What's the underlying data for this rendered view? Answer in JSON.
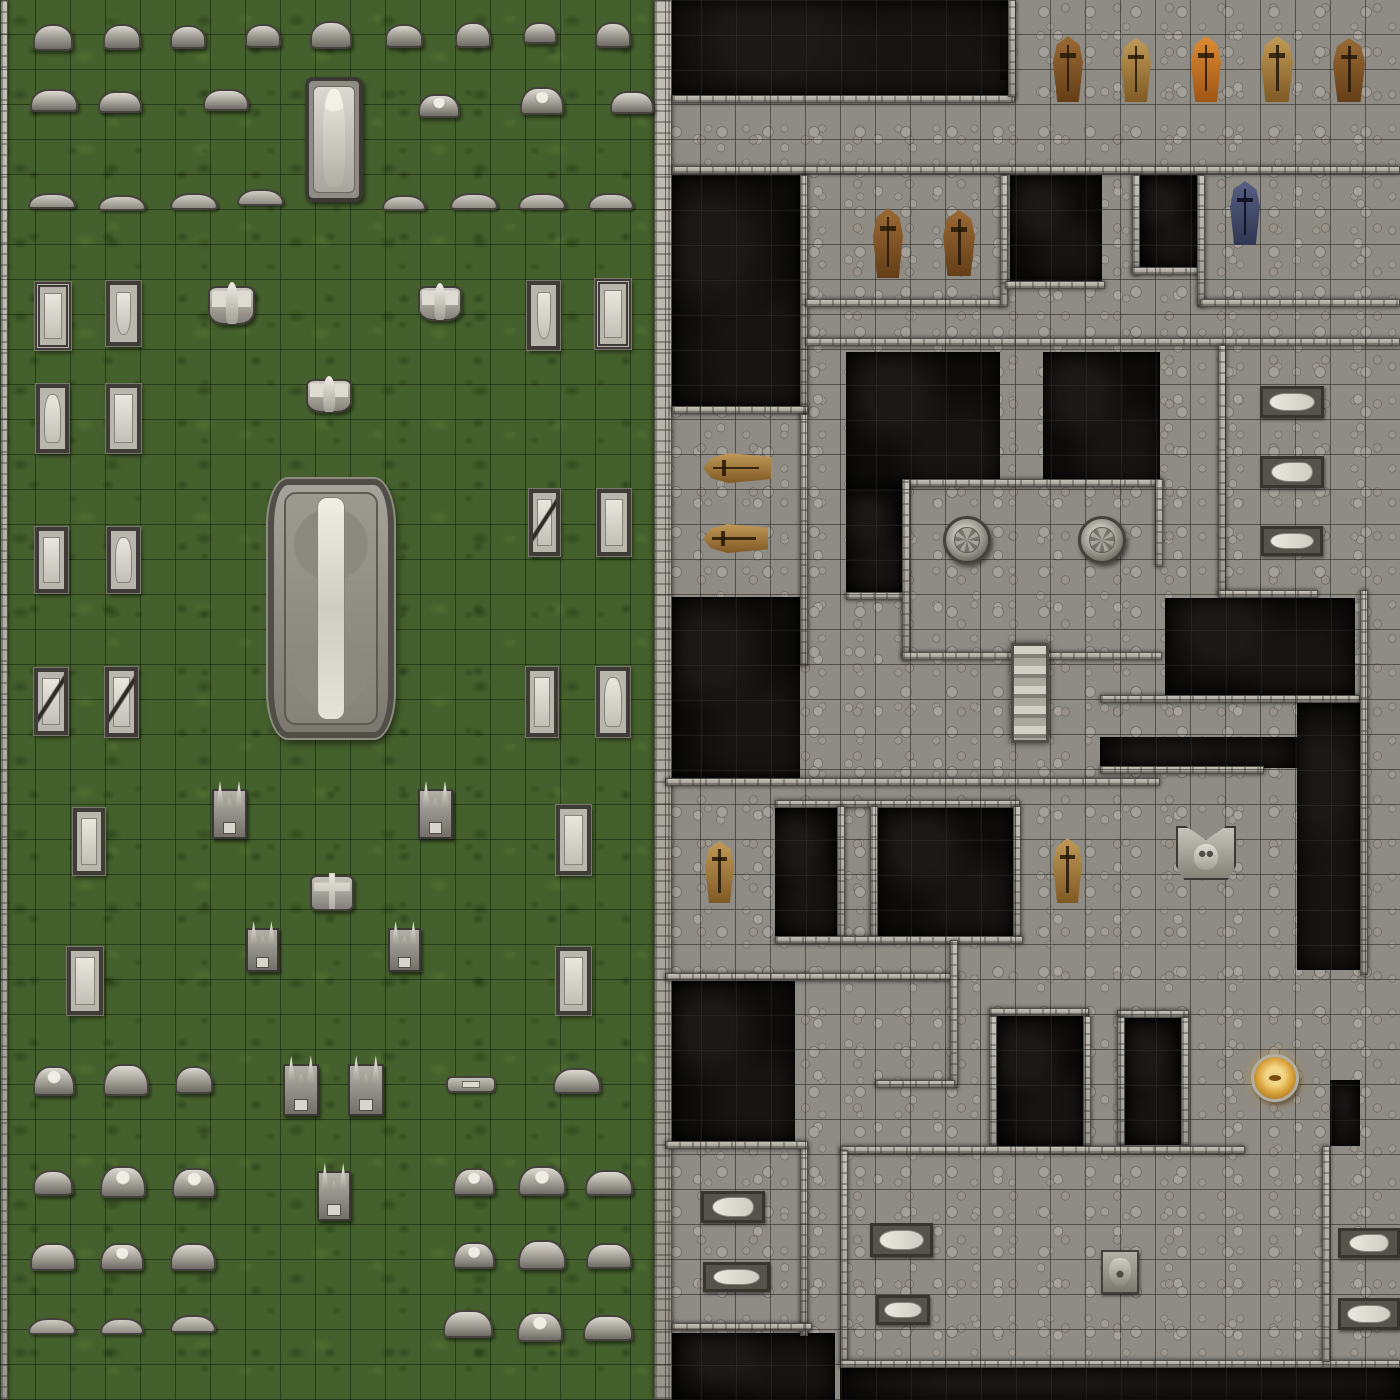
{
  "map": {
    "name": "graveyard-and-crypt-battle-map",
    "width_px": 1400,
    "height_px": 1400,
    "grid": {
      "cell_px": 35,
      "cols": 40,
      "rows": 40
    },
    "palette": {
      "grass": "#44602c",
      "stone": "#8f8c85",
      "wall": "#b0ada5",
      "void": "#0d0c0b",
      "gold": "#d9a33c",
      "coffin_brown": "#7d5226",
      "coffin_tan": "#b3894a",
      "coffin_orange": "#c4722a",
      "coffin_blue": "#3f4766"
    },
    "halves": {
      "cemetery": {
        "x": 0,
        "y": 0,
        "w": 665,
        "h": 1400
      },
      "crypt": {
        "x": 665,
        "y": 0,
        "w": 735,
        "h": 1400
      }
    },
    "object_names": {
      "tombstone": "tombstone",
      "tombstone_wide": "wide-tombstone",
      "tombstone_low": "low-arched-tombstone",
      "grave": "grave-slab",
      "statue_winged": "winged-angel-statue",
      "statue_crucifix": "crucifix-statue",
      "monument_horned": "horned-monument",
      "mausoleum": "mausoleum-monument",
      "angel_tomb": "angel-sarcophagus",
      "marker_flat": "flat-grave-marker",
      "coffin": "wooden-coffin",
      "coffin_h": "wooden-coffin-horizontal",
      "seal": "stone-floor-seal",
      "stairs": "stone-staircase",
      "statue_cat": "gargoyle-face-altar",
      "eye_emblem": "golden-eye-emblem",
      "slab": "burial-slab",
      "face_relief": "carved-face-relief"
    },
    "voids": [
      [
        665,
        0,
        350,
        97
      ],
      [
        1000,
        0,
        16,
        80
      ],
      [
        672,
        175,
        128,
        233
      ],
      [
        1010,
        175,
        92,
        106
      ],
      [
        1140,
        175,
        58,
        93
      ],
      [
        846,
        352,
        154,
        135
      ],
      [
        846,
        487,
        56,
        106
      ],
      [
        1043,
        352,
        117,
        135
      ],
      [
        672,
        597,
        128,
        181
      ],
      [
        1165,
        598,
        190,
        97
      ],
      [
        1100,
        737,
        197,
        31
      ],
      [
        1297,
        703,
        63,
        267
      ],
      [
        775,
        808,
        62,
        128
      ],
      [
        878,
        808,
        135,
        128
      ],
      [
        672,
        981,
        123,
        160
      ],
      [
        997,
        1016,
        86,
        130
      ],
      [
        1125,
        1017,
        56,
        128
      ],
      [
        1330,
        1080,
        30,
        66
      ],
      [
        672,
        1333,
        163,
        67
      ],
      [
        840,
        1368,
        560,
        32
      ]
    ],
    "walls": [
      [
        0,
        0,
        8,
        1400
      ],
      [
        654,
        0,
        18,
        1400
      ],
      [
        672,
        95,
        343,
        8
      ],
      [
        1008,
        0,
        8,
        97
      ],
      [
        672,
        166,
        728,
        8
      ],
      [
        800,
        175,
        8,
        242
      ],
      [
        672,
        406,
        136,
        8
      ],
      [
        805,
        299,
        198,
        8
      ],
      [
        1000,
        175,
        8,
        132
      ],
      [
        1005,
        281,
        100,
        8
      ],
      [
        1132,
        175,
        8,
        100
      ],
      [
        1132,
        267,
        70,
        8
      ],
      [
        1197,
        175,
        8,
        132
      ],
      [
        1200,
        299,
        200,
        8
      ],
      [
        805,
        338,
        595,
        8
      ],
      [
        800,
        414,
        8,
        252
      ],
      [
        846,
        592,
        60,
        8
      ],
      [
        902,
        479,
        260,
        8
      ],
      [
        902,
        479,
        8,
        181
      ],
      [
        902,
        652,
        112,
        8
      ],
      [
        1046,
        652,
        116,
        8
      ],
      [
        1155,
        479,
        8,
        88
      ],
      [
        1218,
        345,
        8,
        250
      ],
      [
        1218,
        590,
        100,
        8
      ],
      [
        1100,
        695,
        260,
        8
      ],
      [
        1100,
        766,
        164,
        8
      ],
      [
        1360,
        590,
        8,
        385
      ],
      [
        665,
        778,
        495,
        8
      ],
      [
        775,
        800,
        245,
        8
      ],
      [
        837,
        806,
        8,
        132
      ],
      [
        870,
        806,
        8,
        132
      ],
      [
        1013,
        806,
        8,
        132
      ],
      [
        775,
        936,
        248,
        8
      ],
      [
        665,
        973,
        293,
        8
      ],
      [
        950,
        940,
        8,
        148
      ],
      [
        875,
        1080,
        80,
        8
      ],
      [
        989,
        1008,
        100,
        8
      ],
      [
        989,
        1016,
        8,
        130
      ],
      [
        1083,
        1016,
        8,
        130
      ],
      [
        1117,
        1010,
        72,
        8
      ],
      [
        1117,
        1017,
        8,
        128
      ],
      [
        1181,
        1017,
        8,
        128
      ],
      [
        840,
        1146,
        405,
        8
      ],
      [
        800,
        1146,
        8,
        190
      ],
      [
        665,
        1141,
        143,
        8
      ],
      [
        672,
        1323,
        140,
        8
      ],
      [
        840,
        1150,
        8,
        212
      ],
      [
        840,
        1360,
        560,
        8
      ],
      [
        1322,
        1146,
        8,
        216
      ]
    ],
    "objects": [
      [
        "tombstone",
        33,
        24,
        40,
        27
      ],
      [
        "tombstone",
        103,
        24,
        38,
        26
      ],
      [
        "tombstone",
        170,
        25,
        36,
        24
      ],
      [
        "tombstone",
        245,
        24,
        36,
        24
      ],
      [
        "tombstone",
        310,
        21,
        42,
        28
      ],
      [
        "tombstone",
        385,
        24,
        38,
        24
      ],
      [
        "tombstone",
        455,
        22,
        36,
        26
      ],
      [
        "tombstone",
        523,
        22,
        34,
        22
      ],
      [
        "tombstone",
        595,
        22,
        36,
        26
      ],
      [
        "tombstone_wide",
        30,
        89,
        48,
        23
      ],
      [
        "tombstone_wide",
        98,
        91,
        44,
        22
      ],
      [
        "tombstone_wide",
        203,
        89,
        46,
        22
      ],
      [
        "tombstone_wide",
        418,
        94,
        42,
        24,
        "skull"
      ],
      [
        "tombstone_wide",
        520,
        87,
        44,
        28,
        "skull"
      ],
      [
        "tombstone_wide",
        610,
        91,
        44,
        23
      ],
      [
        "angel_tomb",
        305,
        77,
        58,
        125
      ],
      [
        "tombstone_low",
        28,
        193,
        48,
        16
      ],
      [
        "tombstone_low",
        98,
        195,
        48,
        16
      ],
      [
        "tombstone_low",
        170,
        193,
        48,
        17
      ],
      [
        "tombstone_low",
        237,
        189,
        47,
        17
      ],
      [
        "tombstone_low",
        382,
        195,
        44,
        16
      ],
      [
        "tombstone_low",
        450,
        193,
        48,
        17
      ],
      [
        "tombstone_low",
        518,
        193,
        48,
        17
      ],
      [
        "tombstone_low",
        588,
        193,
        46,
        17
      ],
      [
        "grave",
        35,
        282,
        36,
        68,
        "ornate"
      ],
      [
        "grave",
        106,
        281,
        35,
        65,
        "shield"
      ],
      [
        "statue_winged",
        208,
        286,
        47,
        39
      ],
      [
        "statue_winged",
        418,
        286,
        44,
        35
      ],
      [
        "grave",
        527,
        281,
        33,
        69,
        "shield"
      ],
      [
        "grave",
        595,
        279,
        36,
        70,
        "ornate"
      ],
      [
        "grave",
        36,
        384,
        33,
        69,
        "figure"
      ],
      [
        "grave",
        106,
        384,
        35,
        69
      ],
      [
        "statue_winged",
        306,
        379,
        46,
        34
      ],
      [
        "mausoleum",
        268,
        479,
        126,
        259
      ],
      [
        "grave",
        529,
        489,
        31,
        67,
        "cracked"
      ],
      [
        "grave",
        597,
        489,
        34,
        67
      ],
      [
        "grave",
        35,
        527,
        33,
        66
      ],
      [
        "grave",
        107,
        527,
        33,
        66,
        "figure"
      ],
      [
        "grave",
        34,
        668,
        34,
        67,
        "cracked"
      ],
      [
        "grave",
        105,
        667,
        33,
        70,
        "cracked"
      ],
      [
        "grave",
        526,
        667,
        32,
        70
      ],
      [
        "grave",
        596,
        667,
        34,
        70,
        "figure"
      ],
      [
        "grave",
        73,
        808,
        32,
        67
      ],
      [
        "monument_horned",
        212,
        789,
        35,
        50
      ],
      [
        "monument_horned",
        418,
        789,
        35,
        50
      ],
      [
        "grave",
        556,
        805,
        35,
        70
      ],
      [
        "statue_crucifix",
        310,
        875,
        44,
        36
      ],
      [
        "monument_horned",
        246,
        928,
        33,
        44
      ],
      [
        "monument_horned",
        388,
        928,
        33,
        44
      ],
      [
        "grave",
        67,
        947,
        36,
        68
      ],
      [
        "grave",
        556,
        947,
        35,
        68
      ],
      [
        "tombstone_wide",
        33,
        1066,
        42,
        30,
        "skull"
      ],
      [
        "tombstone_wide",
        103,
        1064,
        46,
        32
      ],
      [
        "tombstone",
        175,
        1066,
        38,
        28
      ],
      [
        "monument_horned",
        283,
        1064,
        36,
        52
      ],
      [
        "monument_horned",
        348,
        1064,
        36,
        52
      ],
      [
        "marker_flat",
        446,
        1076,
        50,
        17
      ],
      [
        "tombstone_wide",
        553,
        1068,
        48,
        26
      ],
      [
        "tombstone",
        33,
        1170,
        40,
        26
      ],
      [
        "tombstone_wide",
        100,
        1166,
        46,
        32,
        "skull"
      ],
      [
        "tombstone_wide",
        172,
        1168,
        44,
        30,
        "skull"
      ],
      [
        "monument_horned",
        317,
        1171,
        34,
        50
      ],
      [
        "tombstone_wide",
        453,
        1168,
        42,
        28,
        "skull"
      ],
      [
        "tombstone_wide",
        518,
        1166,
        48,
        30,
        "skull"
      ],
      [
        "tombstone_wide",
        585,
        1170,
        48,
        26
      ],
      [
        "tombstone_wide",
        30,
        1243,
        46,
        28
      ],
      [
        "tombstone_wide",
        100,
        1243,
        44,
        28,
        "skull"
      ],
      [
        "tombstone_wide",
        170,
        1243,
        46,
        28
      ],
      [
        "tombstone_wide",
        453,
        1242,
        42,
        27,
        "skull"
      ],
      [
        "tombstone_wide",
        518,
        1240,
        48,
        30
      ],
      [
        "tombstone_wide",
        586,
        1243,
        46,
        26
      ],
      [
        "tombstone_low",
        28,
        1318,
        48,
        17
      ],
      [
        "tombstone_low",
        100,
        1318,
        44,
        17
      ],
      [
        "tombstone_low",
        170,
        1315,
        46,
        18
      ],
      [
        "tombstone_wide",
        443,
        1310,
        50,
        28
      ],
      [
        "tombstone_wide",
        517,
        1312,
        46,
        30,
        "skull"
      ],
      [
        "tombstone_wide",
        583,
        1315,
        50,
        26
      ],
      [
        "coffin",
        1053,
        36,
        30,
        66,
        "brown"
      ],
      [
        "coffin",
        1121,
        38,
        30,
        64,
        "tan"
      ],
      [
        "coffin",
        1191,
        36,
        30,
        66,
        "orange"
      ],
      [
        "coffin",
        1261,
        36,
        32,
        66,
        "tan"
      ],
      [
        "coffin",
        1333,
        38,
        32,
        64,
        "brown"
      ],
      [
        "coffin",
        873,
        208,
        30,
        70,
        "brown"
      ],
      [
        "coffin",
        943,
        210,
        32,
        66,
        "brown"
      ],
      [
        "coffin",
        1230,
        181,
        30,
        64,
        "blue"
      ],
      [
        "coffin_h",
        703,
        453,
        68,
        30,
        "tan"
      ],
      [
        "coffin_h",
        703,
        524,
        65,
        29,
        "tan"
      ],
      [
        "seal",
        943,
        516,
        48,
        48
      ],
      [
        "seal",
        1078,
        516,
        48,
        48
      ],
      [
        "stairs",
        1011,
        643,
        38,
        100
      ],
      [
        "coffin",
        705,
        841,
        29,
        62,
        "tan"
      ],
      [
        "coffin",
        1053,
        838,
        29,
        65,
        "tan"
      ],
      [
        "statue_cat",
        1176,
        826,
        60,
        54
      ],
      [
        "eye_emblem",
        1251,
        1054,
        48,
        48
      ],
      [
        "slab",
        1260,
        386,
        64,
        32
      ],
      [
        "slab",
        1260,
        456,
        64,
        32,
        "figure"
      ],
      [
        "slab",
        1261,
        526,
        62,
        30
      ],
      [
        "slab",
        701,
        1191,
        64,
        32,
        "figure"
      ],
      [
        "slab",
        703,
        1262,
        67,
        30
      ],
      [
        "slab",
        870,
        1223,
        63,
        34
      ],
      [
        "slab",
        876,
        1295,
        54,
        30
      ],
      [
        "slab",
        1338,
        1228,
        62,
        30,
        "figure"
      ],
      [
        "slab",
        1338,
        1298,
        62,
        32
      ],
      [
        "face_relief",
        1101,
        1250,
        38,
        44
      ]
    ]
  }
}
